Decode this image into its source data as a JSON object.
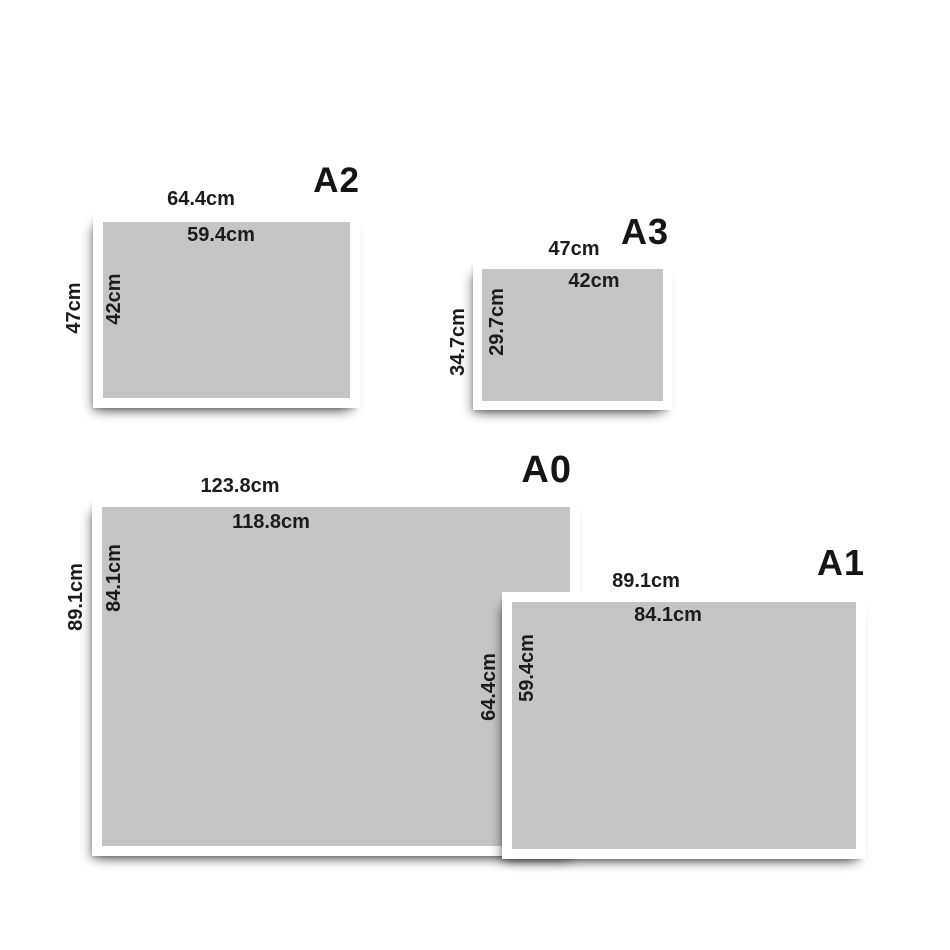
{
  "page": {
    "background_color": "#ffffff",
    "frame_color": "#ffffff",
    "mat_color": "#c5c5c5",
    "text_color": "#1c1c1c",
    "description": "Frame size guide comparing A-series paper sizes"
  },
  "frames": [
    {
      "id": "a2",
      "title": "A2",
      "outer_width": "64.4cm",
      "inner_width": "59.4cm",
      "outer_height": "47cm",
      "inner_height": "42cm"
    },
    {
      "id": "a3",
      "title": "A3",
      "outer_width": "47cm",
      "inner_width": "42cm",
      "outer_height": "34.7cm",
      "inner_height": "29.7cm"
    },
    {
      "id": "a0",
      "title": "A0",
      "outer_width": "123.8cm",
      "inner_width": "118.8cm",
      "outer_height": "89.1cm",
      "inner_height": "84.1cm"
    },
    {
      "id": "a1",
      "title": "A1",
      "outer_width": "89.1cm",
      "inner_width": "84.1cm",
      "outer_height": "64.4cm",
      "inner_height": "59.4cm"
    }
  ]
}
